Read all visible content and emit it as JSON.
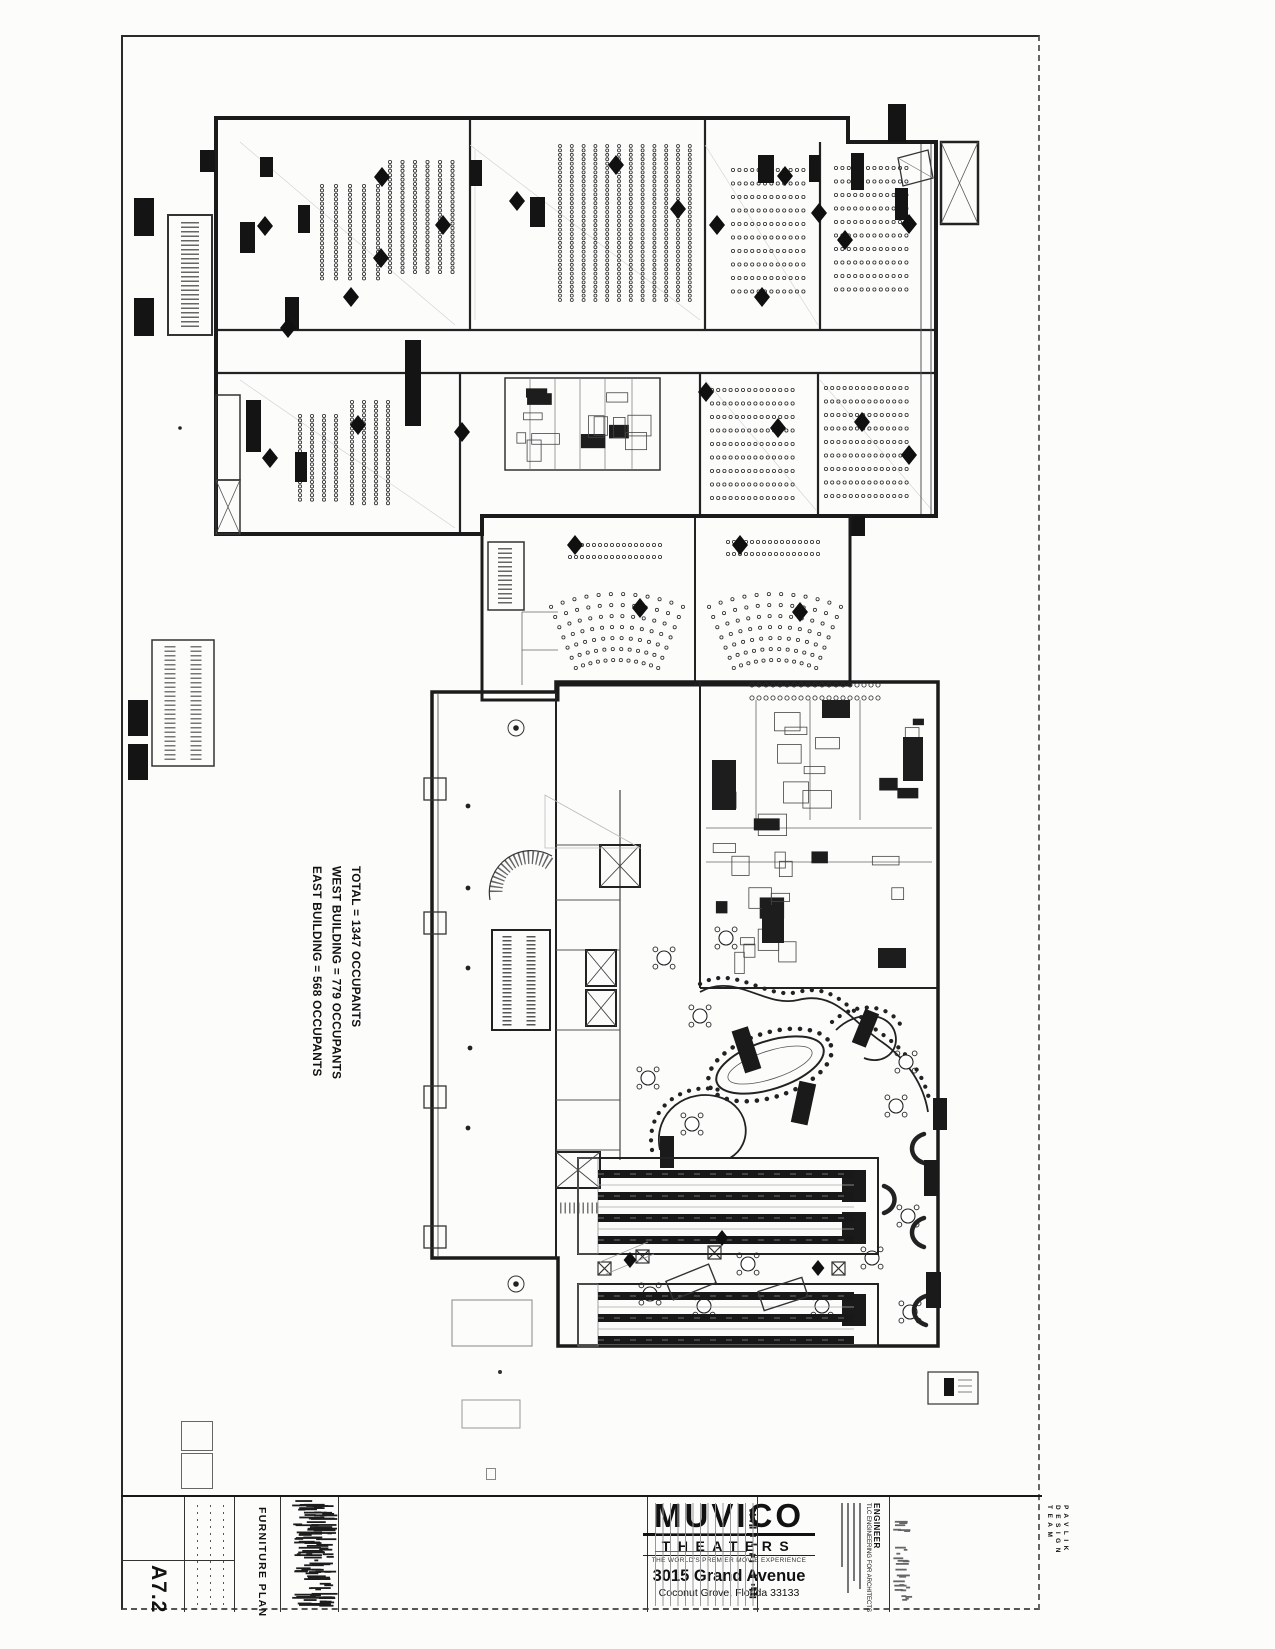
{
  "sheet": {
    "number": "A7.2",
    "discipline_title": "FURNITURE PLAN"
  },
  "occupancy": {
    "total": "TOTAL = 1347 OCCUPANTS",
    "west_building": "WEST BUILDING = 779 OCCUPANTS",
    "east_building": "EAST BUILDING = 568 OCCUPANTS"
  },
  "logo": {
    "brand": "MUVICO",
    "sub_brand": "THEATERS",
    "tagline": "THE WORLD'S PREMIER MOVIE EXPERIENCE",
    "address_line1": "3015 Grand Avenue",
    "address_line2": "Coconut Grove, Florida 33133"
  },
  "engineer": {
    "label": "ENGINEER",
    "firm": "TLC ENGINEERING FOR ARCHITECTS"
  },
  "design_team": {
    "line1": "PAVLIK",
    "line2": "DESIGN",
    "line3": "TEAM"
  }
}
